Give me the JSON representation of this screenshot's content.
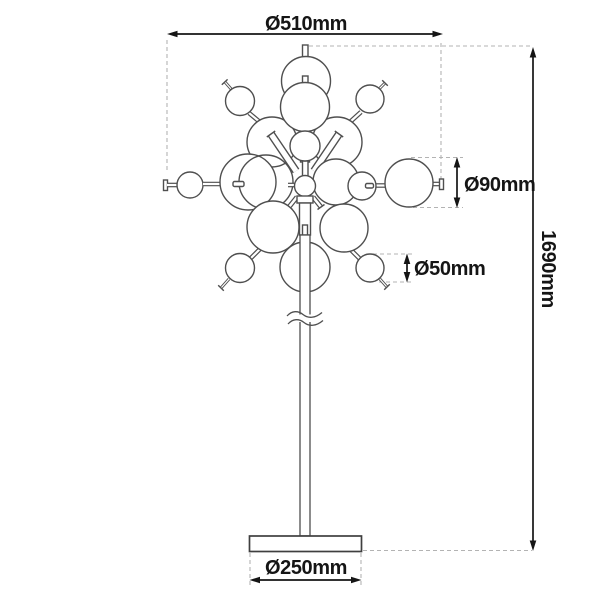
{
  "drawing": {
    "type": "technical-dimension-diagram",
    "labels": {
      "head_diameter": "Ø510mm",
      "large_globe_diameter": "Ø90mm",
      "small_globe_diameter": "Ø50mm",
      "overall_height": "1690mm",
      "base_diameter": "Ø250mm"
    },
    "colors": {
      "outline": "#4f4f4f",
      "dimension": "#151515",
      "guide_dashed": "#b3b3b3",
      "background": "#ffffff"
    }
  }
}
